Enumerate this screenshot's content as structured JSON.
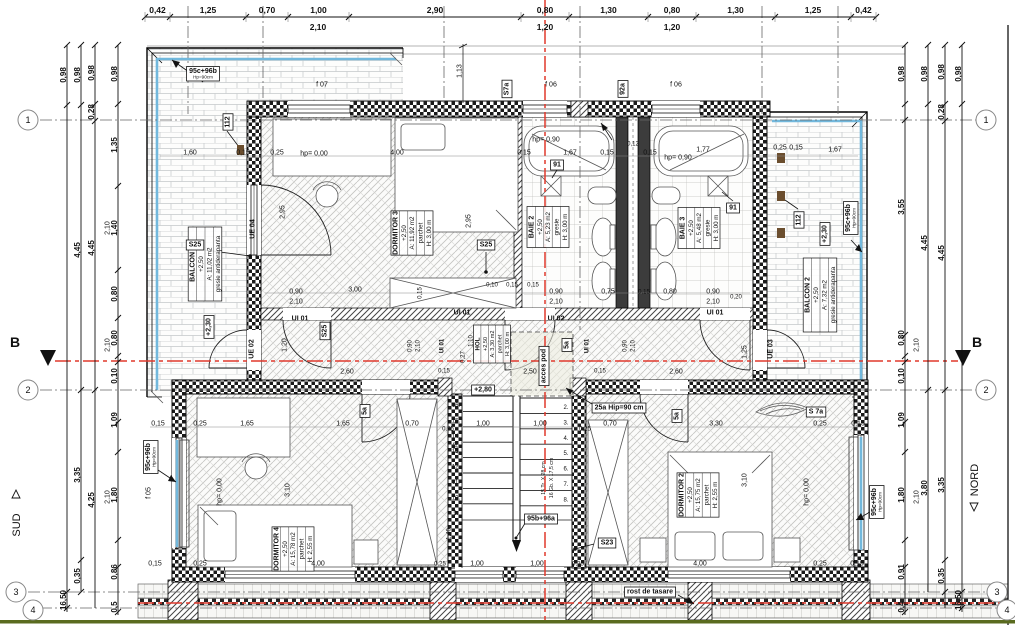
{
  "colors": {
    "section_red": "#e0392c",
    "glazing_blue": "#72b8dc",
    "ground_green": "#5a6b1f",
    "paper": "#ffffff",
    "ink": "#111111"
  },
  "axis_markers": {
    "section": "B",
    "south": "SUD",
    "north": "NORD",
    "circles": [
      {
        "n": "1",
        "x": 28,
        "y": 120
      },
      {
        "n": "2",
        "x": 28,
        "y": 390
      },
      {
        "n": "3",
        "x": 16,
        "y": 592
      },
      {
        "n": "4",
        "x": 33,
        "y": 610
      },
      {
        "n": "1",
        "x": 986,
        "y": 120
      },
      {
        "n": "2",
        "x": 986,
        "y": 390
      },
      {
        "n": "3",
        "x": 997,
        "y": 592
      },
      {
        "n": "4",
        "x": 1007,
        "y": 610
      }
    ]
  },
  "rooms": [
    {
      "name": "BALCON 1",
      "lines": [
        "BALCON 1",
        "+2,50",
        "A: 11,02 m2",
        "gresie antiderapanta"
      ],
      "cx": 205,
      "cy": 264
    },
    {
      "name": "DORMITOR 3",
      "lines": [
        "DORMITOR 3",
        "+2,50",
        "A: 11,92 m2",
        "parchet",
        "H: 3,00 m"
      ],
      "cx": 412,
      "cy": 233
    },
    {
      "name": "BAIE 2",
      "lines": [
        "BAIE 2",
        "+2,50",
        "A: 5,23 m2",
        "gresie",
        "H: 3,00 m"
      ],
      "cx": 548,
      "cy": 227
    },
    {
      "name": "BAIE 3",
      "lines": [
        "BAIE 3",
        "+2,50",
        "A: 5,48 m2",
        "gresie",
        "H: 3,00 m"
      ],
      "cx": 699,
      "cy": 228
    },
    {
      "name": "BALCON 2",
      "lines": [
        "BALCON 2",
        "+2,50",
        "A: 7,32 m2",
        "gresie antiderapanta"
      ],
      "cx": 820,
      "cy": 295
    },
    {
      "name": "HOL",
      "lines": [
        "HOL",
        "+2,50",
        "A: 3,30 m2",
        "parchet",
        "H: 3,00 m"
      ],
      "cx": 492,
      "cy": 344,
      "small": 1
    },
    {
      "name": "DORMITOR 4",
      "lines": [
        "DORMITOR 4",
        "+2,50",
        "A: 15,78 m2",
        "parchet",
        "H: 2,55 m"
      ],
      "cx": 293,
      "cy": 549
    },
    {
      "name": "DORMITOR 2",
      "lines": [
        "DORMITOR 2",
        "+2,50",
        "A: 15,75 m2",
        "parchet",
        "H: 2,55 m"
      ],
      "cx": 698,
      "cy": 495
    }
  ],
  "dims": {
    "top": {
      "y": 17,
      "boundaries": [
        145,
        170,
        246,
        288,
        349,
        521,
        569,
        648,
        696,
        775,
        851,
        876
      ],
      "labels": [
        "0,42",
        "1,25",
        "0,70",
        "1,00",
        "2,90",
        "0,80",
        "1,30",
        "0,80",
        "1,30",
        "1,25",
        "0,42"
      ],
      "sub": [
        {
          "t": "2,10",
          "x": 318,
          "y": 30
        },
        {
          "t": "1,20",
          "x": 545,
          "y": 30
        },
        {
          "t": "1,20",
          "x": 672,
          "y": 30
        }
      ]
    },
    "vchains": [
      {
        "x": 67,
        "y1": 45,
        "y2": 612,
        "ticks": [
          45,
          105,
          592,
          608
        ],
        "labels": [
          {
            "t": "0,98",
            "y": 75
          },
          {
            "t": "16,50",
            "y": 600
          }
        ]
      },
      {
        "x": 81,
        "y1": 45,
        "y2": 592,
        "ticks": [
          45,
          105,
          390,
          560,
          592
        ],
        "labels": [
          {
            "t": "0,98",
            "y": 75
          },
          {
            "t": "4,45",
            "y": 250
          },
          {
            "t": "3,35",
            "y": 475
          },
          {
            "t": "0,35",
            "y": 576
          }
        ]
      },
      {
        "x": 95,
        "y1": 45,
        "y2": 608,
        "ticks": [
          45,
          104,
          121,
          390
        ],
        "labels": [
          {
            "t": "0,98",
            "y": 73
          },
          {
            "t": "0,28",
            "y": 112
          },
          {
            "t": "4,45",
            "y": 248
          },
          {
            "t": "4,25",
            "y": 500
          }
        ]
      },
      {
        "x": 118,
        "y1": 45,
        "y2": 615,
        "ticks": [
          45,
          104,
          186,
          270,
          318,
          356,
          362,
          422,
          452,
          540,
          567,
          612
        ],
        "labels": [
          {
            "t": "0,98",
            "y": 74
          },
          {
            "t": "1,35",
            "y": 145
          },
          {
            "t": "1,40",
            "y": 228
          },
          {
            "t": "0,80",
            "y": 294
          },
          {
            "t": "0,80",
            "y": 338
          },
          {
            "t": "0,10",
            "y": 376
          },
          {
            "t": "1,09",
            "y": 420
          },
          {
            "t": "1,80",
            "y": 495
          },
          {
            "t": "0,86",
            "y": 572
          },
          {
            "t": "0,5",
            "y": 607
          }
        ]
      },
      {
        "x": 905,
        "y1": 45,
        "y2": 615,
        "ticks": [
          45,
          104,
          120,
          335,
          356,
          362,
          422,
          452,
          540,
          567,
          612
        ],
        "labels": [
          {
            "t": "0,98",
            "y": 74
          },
          {
            "t": "3,55",
            "y": 207
          },
          {
            "t": "0,80",
            "y": 338
          },
          {
            "t": "0,10",
            "y": 376
          },
          {
            "t": "1,09",
            "y": 420
          },
          {
            "t": "1,80",
            "y": 495
          },
          {
            "t": "0,91",
            "y": 572
          },
          {
            "t": "0,4",
            "y": 607
          }
        ]
      },
      {
        "x": 928,
        "y1": 45,
        "y2": 592,
        "ticks": [
          45,
          104,
          390
        ],
        "labels": [
          {
            "t": "0,98",
            "y": 74
          },
          {
            "t": "4,45",
            "y": 243
          },
          {
            "t": "3,80",
            "y": 488
          }
        ]
      },
      {
        "x": 945,
        "y1": 45,
        "y2": 608,
        "ticks": [
          45,
          104,
          121,
          390,
          560,
          592
        ],
        "labels": [
          {
            "t": "0,98",
            "y": 72
          },
          {
            "t": "0,28",
            "y": 112
          },
          {
            "t": "4,45",
            "y": 253
          },
          {
            "t": "3,35",
            "y": 485
          },
          {
            "t": "0,35",
            "y": 576
          }
        ]
      },
      {
        "x": 962,
        "y1": 45,
        "y2": 612,
        "ticks": [
          45,
          104,
          592,
          608
        ],
        "labels": [
          {
            "t": "0,98",
            "y": 74
          },
          {
            "t": "16,50",
            "y": 600
          }
        ]
      }
    ]
  },
  "stairs": {
    "left_numbers": [
      "16.",
      "15.",
      "14.",
      "13.",
      "12.",
      "11.",
      "10.",
      "9."
    ],
    "right_numbers": [
      "2.",
      "3.",
      "4.",
      "5.",
      "6.",
      "7.",
      "8."
    ],
    "note1": "15 Tr. X 28 cm",
    "note2": "16 Gb. X 17,5 cm"
  },
  "labels": [
    {
      "t": "1,60",
      "x": 190,
      "y": 152
    },
    {
      "t": "0,15",
      "x": 243,
      "y": 152
    },
    {
      "t": "0,25",
      "x": 277,
      "y": 152
    },
    {
      "t": "hp= 0,00",
      "x": 314,
      "y": 153
    },
    {
      "t": "4,00",
      "x": 397,
      "y": 152
    },
    {
      "t": "hp= 0,90",
      "x": 546,
      "y": 139
    },
    {
      "t": "0,15",
      "x": 524,
      "y": 152
    },
    {
      "t": "1,67",
      "x": 570,
      "y": 152
    },
    {
      "t": "0,15",
      "x": 607,
      "y": 152
    },
    {
      "t": "0,12",
      "x": 633,
      "y": 143,
      "fs": 6
    },
    {
      "t": "0,15",
      "x": 650,
      "y": 152
    },
    {
      "t": "hp= 0,90",
      "x": 678,
      "y": 157
    },
    {
      "t": "1,77",
      "x": 703,
      "y": 149
    },
    {
      "t": "0,25",
      "x": 780,
      "y": 147
    },
    {
      "t": "0,15",
      "x": 796,
      "y": 147
    },
    {
      "t": "1,67",
      "x": 835,
      "y": 149
    },
    {
      "t": "1,13",
      "x": 459,
      "y": 71,
      "r": 1
    },
    {
      "t": "2,95",
      "x": 282,
      "y": 212,
      "r": 1
    },
    {
      "t": "2,95",
      "x": 468,
      "y": 221,
      "r": 1
    },
    {
      "t": "3,00",
      "x": 355,
      "y": 289
    },
    {
      "t": "0,15",
      "x": 419,
      "y": 293,
      "r": 1,
      "fs": 6
    },
    {
      "t": "0,10",
      "x": 492,
      "y": 284,
      "fs": 6
    },
    {
      "t": "0,15",
      "x": 512,
      "y": 284,
      "fs": 6
    },
    {
      "t": "0,15",
      "x": 533,
      "y": 284,
      "fs": 6
    },
    {
      "t": "0,90",
      "x": 296,
      "y": 291
    },
    {
      "t": "2,10",
      "x": 296,
      "y": 301
    },
    {
      "t": "0,90",
      "x": 556,
      "y": 291
    },
    {
      "t": "2,10",
      "x": 556,
      "y": 301
    },
    {
      "t": "0,75",
      "x": 608,
      "y": 291
    },
    {
      "t": "0,15",
      "x": 644,
      "y": 291,
      "fs": 6
    },
    {
      "t": "0,80",
      "x": 670,
      "y": 291
    },
    {
      "t": "0,90",
      "x": 713,
      "y": 291
    },
    {
      "t": "2,10",
      "x": 713,
      "y": 301
    },
    {
      "t": "0,20",
      "x": 736,
      "y": 296,
      "fs": 6
    },
    {
      "t": "1,20",
      "x": 284,
      "y": 345,
      "r": 1
    },
    {
      "t": "1,25",
      "x": 744,
      "y": 352,
      "r": 1
    },
    {
      "t": "2,60",
      "x": 347,
      "y": 371
    },
    {
      "t": "0,15",
      "x": 444,
      "y": 370,
      "fs": 6
    },
    {
      "t": "2,50",
      "x": 530,
      "y": 371
    },
    {
      "t": "0,15",
      "x": 600,
      "y": 370,
      "fs": 6
    },
    {
      "t": "2,60",
      "x": 676,
      "y": 371
    },
    {
      "t": "1,10",
      "x": 470,
      "y": 341,
      "r": 1,
      "fs": 6
    },
    {
      "t": "0,27",
      "x": 462,
      "y": 357,
      "r": 1,
      "fs": 6
    },
    {
      "t": "0,90",
      "x": 409,
      "y": 346,
      "r": 1,
      "fs": 6
    },
    {
      "t": "2,10",
      "x": 417,
      "y": 346,
      "r": 1,
      "fs": 6
    },
    {
      "t": "0,90",
      "x": 624,
      "y": 346,
      "r": 1,
      "fs": 6
    },
    {
      "t": "2,10",
      "x": 632,
      "y": 346,
      "r": 1,
      "fs": 6
    },
    {
      "t": "0,15",
      "x": 158,
      "y": 423
    },
    {
      "t": "0,25",
      "x": 200,
      "y": 423
    },
    {
      "t": "1,65",
      "x": 247,
      "y": 423
    },
    {
      "t": "1,65",
      "x": 343,
      "y": 423
    },
    {
      "t": "0,70",
      "x": 412,
      "y": 423
    },
    {
      "t": "0,25",
      "x": 448,
      "y": 428,
      "fs": 6
    },
    {
      "t": "1,00",
      "x": 483,
      "y": 423
    },
    {
      "t": "1,00",
      "x": 540,
      "y": 423
    },
    {
      "t": "0,25",
      "x": 585,
      "y": 428,
      "fs": 6
    },
    {
      "t": "0,70",
      "x": 610,
      "y": 423
    },
    {
      "t": "3,30",
      "x": 716,
      "y": 423
    },
    {
      "t": "0,25",
      "x": 820,
      "y": 423
    },
    {
      "t": "0,15",
      "x": 858,
      "y": 423
    },
    {
      "t": "1,68",
      "x": 455,
      "y": 448,
      "r": 1,
      "fs": 6
    },
    {
      "t": "1,40",
      "x": 448,
      "y": 534,
      "r": 1,
      "fs": 6
    },
    {
      "t": "3,10",
      "x": 287,
      "y": 490,
      "r": 1
    },
    {
      "t": "3,10",
      "x": 744,
      "y": 480,
      "r": 1
    },
    {
      "t": "hp= 0,00",
      "x": 219,
      "y": 492,
      "r": 1
    },
    {
      "t": "hp= 0,00",
      "x": 806,
      "y": 492,
      "r": 1
    },
    {
      "t": "0,15",
      "x": 155,
      "y": 563
    },
    {
      "t": "0,25",
      "x": 200,
      "y": 563
    },
    {
      "t": "4,00",
      "x": 318,
      "y": 563
    },
    {
      "t": "0,25",
      "x": 440,
      "y": 563,
      "fs": 6
    },
    {
      "t": "1,00",
      "x": 477,
      "y": 563
    },
    {
      "t": "1,00",
      "x": 537,
      "y": 563
    },
    {
      "t": "0,25",
      "x": 578,
      "y": 563,
      "fs": 6
    },
    {
      "t": "4,00",
      "x": 700,
      "y": 563
    },
    {
      "t": "0,25",
      "x": 820,
      "y": 563
    },
    {
      "t": "0,15",
      "x": 857,
      "y": 563
    },
    {
      "t": "2,10",
      "x": 107,
      "y": 228,
      "r": 1
    },
    {
      "t": "2,10",
      "x": 107,
      "y": 345,
      "r": 1
    },
    {
      "t": "2,10",
      "x": 107,
      "y": 497,
      "r": 1
    },
    {
      "t": "2,10",
      "x": 916,
      "y": 345,
      "r": 1
    },
    {
      "t": "2,10",
      "x": 916,
      "y": 497,
      "r": 1
    },
    {
      "t": "f 07",
      "x": 322,
      "y": 84
    },
    {
      "t": "f 06",
      "x": 551,
      "y": 84
    },
    {
      "t": "f 06",
      "x": 676,
      "y": 84
    },
    {
      "t": "f 05",
      "x": 148,
      "y": 493,
      "r": 1
    },
    {
      "t": "UI 01",
      "x": 300,
      "y": 318,
      "w": 1
    },
    {
      "t": "UI 01",
      "x": 462,
      "y": 312,
      "w": 1
    },
    {
      "t": "UI 02",
      "x": 556,
      "y": 318,
      "w": 1
    },
    {
      "t": "UI 01",
      "x": 715,
      "y": 312,
      "w": 1
    },
    {
      "t": "UI 01",
      "x": 441,
      "y": 346,
      "r": 1,
      "fs": 6,
      "w": 1
    },
    {
      "t": "UI 01",
      "x": 586,
      "y": 346,
      "r": 1,
      "fs": 6,
      "w": 1
    },
    {
      "t": "UE 04",
      "x": 252,
      "y": 229,
      "r": 1,
      "w": 1
    },
    {
      "t": "UE 02",
      "x": 251,
      "y": 349,
      "r": 1,
      "w": 1
    },
    {
      "t": "UE 03",
      "x": 770,
      "y": 349,
      "r": 1,
      "w": 1
    },
    {
      "t": "112",
      "x": 227,
      "y": 122,
      "r": 1,
      "b": 1
    },
    {
      "t": "112",
      "x": 798,
      "y": 220,
      "r": 1,
      "b": 1
    },
    {
      "t": "92a",
      "x": 622,
      "y": 89,
      "r": 1,
      "b": 1
    },
    {
      "t": "S7a",
      "x": 506,
      "y": 89,
      "r": 1,
      "b": 1
    },
    {
      "t": "S 7a",
      "x": 816,
      "y": 411,
      "b": 1
    },
    {
      "t": "91",
      "x": 557,
      "y": 164,
      "b": 1
    },
    {
      "t": "91",
      "x": 733,
      "y": 207,
      "b": 1
    },
    {
      "t": "S25",
      "x": 195,
      "y": 244,
      "b": 1
    },
    {
      "t": "S25",
      "x": 486,
      "y": 244,
      "b": 1
    },
    {
      "t": "S25",
      "x": 324,
      "y": 331,
      "r": 1,
      "b": 1
    },
    {
      "t": "S23",
      "x": 607,
      "y": 542,
      "b": 1
    },
    {
      "t": "5a",
      "x": 566,
      "y": 345,
      "r": 1,
      "b": 1
    },
    {
      "t": "5a",
      "x": 364,
      "y": 411,
      "r": 1,
      "b": 1
    },
    {
      "t": "5a",
      "x": 676,
      "y": 416,
      "r": 1,
      "b": 1
    },
    {
      "t": "25a Hip=90 cm",
      "x": 619,
      "y": 407,
      "b": 1
    },
    {
      "t": "95b+96a",
      "x": 541,
      "y": 518,
      "b": 1
    },
    {
      "t": "+2,80",
      "x": 483,
      "y": 389,
      "b": 1
    },
    {
      "t": "+2,30",
      "x": 208,
      "y": 327,
      "r": 1,
      "b": 1
    },
    {
      "t": "+2,30",
      "x": 824,
      "y": 234,
      "r": 1,
      "b": 1
    },
    {
      "t": "rost de tasare",
      "x": 650,
      "y": 591,
      "b": 1
    },
    {
      "t": "acces pod",
      "x": 543,
      "y": 366,
      "r": 1,
      "b": 1
    },
    {
      "t": "95c+96b",
      "t2": "Hp=90cm",
      "x": 203,
      "y": 74,
      "b": 1
    },
    {
      "t": "95c+96b",
      "t2": "Hp=90cm",
      "x": 851,
      "y": 218,
      "r": 1,
      "b": 1
    },
    {
      "t": "95c+96b",
      "t2": "Hp=90cm",
      "x": 151,
      "y": 457,
      "r": 1,
      "b": 1
    },
    {
      "t": "95c+96b",
      "t2": "Hp=90cm",
      "x": 877,
      "y": 502,
      "r": 1,
      "b": 1
    }
  ]
}
